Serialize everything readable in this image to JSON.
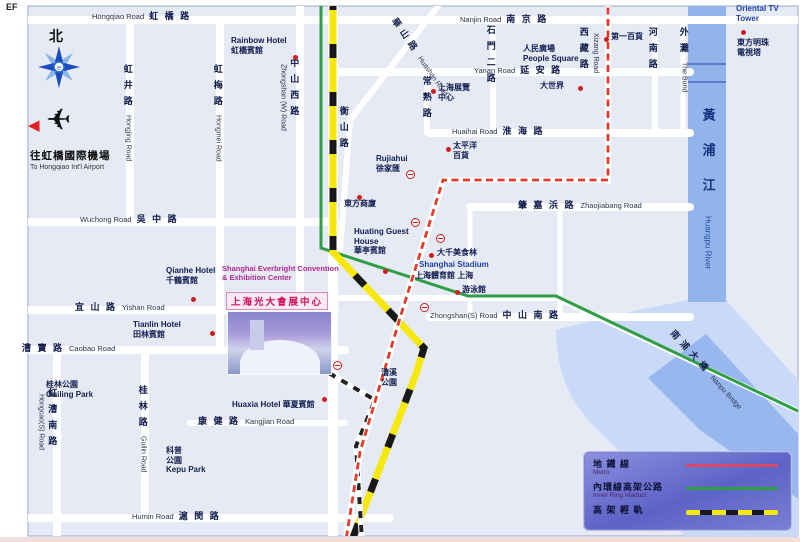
{
  "page": {
    "corner_text": "EF"
  },
  "compass": {
    "north_label": "北"
  },
  "airport": {
    "cn": "往虹橋國際機場",
    "en": "To Hongqiao Int'l Airport"
  },
  "convention": {
    "en_line1": "Shanghai Everbright Convention",
    "en_line2": "& Exhibition Center",
    "banner": "上海光大會展中心"
  },
  "legend": {
    "rows": [
      {
        "cn": "地  鐵  線",
        "en": "Metro",
        "type": "metro"
      },
      {
        "cn": "內環線高架公路",
        "en": "Inner Ring Viaduct",
        "type": "ring"
      },
      {
        "cn": "高 架 輕 軌",
        "en": "",
        "type": "rail"
      }
    ]
  },
  "colors": {
    "metro_red": "#e83828",
    "ring_green": "#2f9e44",
    "rail_yellow": "#f6e80a",
    "river_blue": "#92b4ec",
    "map_bg": "#e6eaf5"
  },
  "map": {
    "labels": [
      {
        "name": "road-hongqiao",
        "k": "rh",
        "en": "Hongqiao Road",
        "cn": "虹 橋 路",
        "x": 92,
        "y": 11
      },
      {
        "name": "road-nanjing",
        "k": "rh",
        "en": "Nanjin Road",
        "cn": "南 京 路",
        "x": 460,
        "y": 14
      },
      {
        "name": "road-yanan",
        "k": "rh",
        "en": "Yanan Road",
        "cn": "延 安 路",
        "x": 474,
        "y": 65
      },
      {
        "name": "road-huaihai",
        "k": "rh",
        "en": "Huaihai Road",
        "cn": "淮 海 路",
        "x": 452,
        "y": 126
      },
      {
        "name": "road-wuzhong",
        "k": "rh",
        "en": "Wuchong Road",
        "cn": "吳 中 路",
        "x": 80,
        "y": 214
      },
      {
        "name": "road-zhaojiabang",
        "k": "rh",
        "cn": "肇 嘉 浜 路",
        "en": "Zhaojiabang Road",
        "cnFirst": true,
        "x": 518,
        "y": 200
      },
      {
        "name": "road-yishan",
        "k": "rh",
        "cn": "宜 山 路",
        "en": "Yishan Road",
        "cnFirst": true,
        "x": 75,
        "y": 302
      },
      {
        "name": "road-zhongshan-s",
        "k": "rh",
        "en": "Zhongshan(S) Road",
        "cn": "中 山 南 路",
        "x": 430,
        "y": 310
      },
      {
        "name": "road-caobao",
        "k": "rh",
        "cn": "漕 寶 路",
        "en": "Caobao Road",
        "cnFirst": true,
        "x": 22,
        "y": 343
      },
      {
        "name": "road-kangjian",
        "k": "rh",
        "cn": "康 健 路",
        "en": "Kangjian Road",
        "cnFirst": true,
        "x": 198,
        "y": 416
      },
      {
        "name": "road-humin",
        "k": "rh",
        "en": "Humin Road",
        "cn": "滬 閔 路",
        "x": 132,
        "y": 511
      },
      {
        "name": "road-hongjing",
        "k": "rv",
        "cn": "虹井路",
        "en": "Hongjing Road",
        "x": 122,
        "y": 64
      },
      {
        "name": "road-hongmei",
        "k": "rv",
        "cn": "虹梅路",
        "en": "Hongmei Road",
        "x": 212,
        "y": 64
      },
      {
        "name": "road-zhongshan-w",
        "k": "rv",
        "cn": "中山西路",
        "en": "Zhongshan (W) Road",
        "side": "l",
        "x": 278,
        "y": 58
      },
      {
        "name": "road-hengshan",
        "k": "rv",
        "cn": "衡山路",
        "x": 338,
        "y": 106
      },
      {
        "name": "road-changshu",
        "k": "rv",
        "cn": "常熟路",
        "x": 421,
        "y": 76
      },
      {
        "name": "road-shimener",
        "k": "rv",
        "cn": "石門二路",
        "x": 485,
        "y": 25
      },
      {
        "name": "road-xizang",
        "k": "rv",
        "cn": "西藏路",
        "en": "Xizang Road",
        "side": "r",
        "x": 578,
        "y": 27
      },
      {
        "name": "road-henan",
        "k": "rv",
        "cn": "河南路",
        "x": 647,
        "y": 27
      },
      {
        "name": "the-bund",
        "k": "rv",
        "cn": "外灘",
        "en": "The Bund",
        "x": 678,
        "y": 27
      },
      {
        "name": "road-guilin",
        "k": "rv",
        "cn": "桂林路",
        "en": "Guilin Road",
        "x": 137,
        "y": 385
      },
      {
        "name": "road-hongcao-s",
        "k": "rv",
        "cn": "虹漕南路",
        "en": "Hongcao(S) Road",
        "side": "l",
        "x": 36,
        "y": 388
      },
      {
        "name": "huangpu-river-label",
        "k": "rv",
        "cls": "riverlbl",
        "cn": "黃浦江",
        "en": "Huangpu River",
        "x": 700,
        "y": 108
      },
      {
        "name": "road-huashan",
        "k": "diag",
        "cn": "華山路",
        "en": "Huashan Road",
        "rot": 55,
        "x": 398,
        "y": 16
      },
      {
        "name": "nanpu-bridge-label",
        "k": "diag",
        "cn": "南浦大橋",
        "en": "Nanpu Bridge",
        "rot": 48,
        "x": 676,
        "y": 328
      },
      {
        "name": "poi-rainbow-hotel",
        "k": "poi",
        "lines": [
          "Rainbow Hotel",
          "虹橋賓館"
        ],
        "x": 231,
        "y": 36
      },
      {
        "name": "poi-qianhe-hotel",
        "k": "poi",
        "lines": [
          "Qianhe Hotel",
          "千鶴賓館"
        ],
        "x": 166,
        "y": 266
      },
      {
        "name": "poi-tianlin-hotel",
        "k": "poi",
        "lines": [
          "Tianlin Hotel",
          "田林賓館"
        ],
        "x": 133,
        "y": 320
      },
      {
        "name": "poi-people-square",
        "k": "poi",
        "lines": [
          "人民廣場",
          "People Square"
        ],
        "x": 523,
        "y": 44
      },
      {
        "name": "poi-shanghai-exhibition-center",
        "k": "poi",
        "lines": [
          "上海展覽",
          "中心"
        ],
        "x": 438,
        "y": 83
      },
      {
        "name": "poi-great-world",
        "k": "poi",
        "lines": [
          "大世界"
        ],
        "x": 540,
        "y": 81
      },
      {
        "name": "poi-no1-department-store",
        "k": "poi",
        "lines": [
          "第一百貨"
        ],
        "x": 611,
        "y": 32
      },
      {
        "name": "poi-oriental-tv-tower-en",
        "k": "poi",
        "cls": "blue",
        "lines": [
          "Oriental TV",
          "Tower"
        ],
        "x": 736,
        "y": 4
      },
      {
        "name": "poi-oriental-tv-tower",
        "k": "poi",
        "lines": [
          "東方明珠",
          "電視塔"
        ],
        "x": 737,
        "y": 38
      },
      {
        "name": "poi-pacific-department-store",
        "k": "poi",
        "lines": [
          "太平洋",
          "百貨"
        ],
        "x": 453,
        "y": 141
      },
      {
        "name": "poi-xujiahui",
        "k": "poi",
        "lines": [
          "Rujiahui",
          "徐家匯"
        ],
        "x": 376,
        "y": 154
      },
      {
        "name": "poi-oriental-shopping-centre",
        "k": "poi",
        "lines": [
          "東方商廈"
        ],
        "x": 344,
        "y": 199
      },
      {
        "name": "poi-huating-guest-house",
        "k": "poi",
        "lines": [
          "Huating Guest",
          "House",
          "華亭賓館"
        ],
        "x": 354,
        "y": 227
      },
      {
        "name": "poi-daqian-gourmet",
        "k": "poi",
        "lines": [
          "大千美食林"
        ],
        "x": 437,
        "y": 248
      },
      {
        "name": "poi-shanghai-stadium-en",
        "k": "poi",
        "cls": "blue",
        "lines": [
          "Shanghai Stadium"
        ],
        "x": 419,
        "y": 260
      },
      {
        "name": "poi-shanghai-stadium",
        "k": "poi",
        "lines": [
          "上海體育館 上海"
        ],
        "x": 415,
        "y": 271
      },
      {
        "name": "poi-swimming-center",
        "k": "poi",
        "lines": [
          "游泳館"
        ],
        "x": 462,
        "y": 285
      },
      {
        "name": "poi-huaxia-hotel",
        "k": "poi",
        "lines": [
          "Huaxia Hotel 華夏賓館"
        ],
        "x": 232,
        "y": 400
      },
      {
        "name": "area-guilin-park",
        "k": "area",
        "lines": [
          "桂林公園",
          "Guiling Park"
        ],
        "x": 46,
        "y": 380
      },
      {
        "name": "area-kepu-park",
        "k": "area",
        "lines": [
          "科普",
          "公園",
          "Kepu Park"
        ],
        "x": 166,
        "y": 446
      },
      {
        "name": "area-caoxi-park",
        "k": "area",
        "lines": [
          "漕溪",
          "公園"
        ],
        "x": 381,
        "y": 368
      }
    ],
    "dots": [
      {
        "x": 293,
        "y": 55
      },
      {
        "x": 191,
        "y": 297
      },
      {
        "x": 210,
        "y": 331
      },
      {
        "x": 431,
        "y": 89
      },
      {
        "x": 578,
        "y": 86
      },
      {
        "x": 604,
        "y": 37
      },
      {
        "x": 741,
        "y": 30
      },
      {
        "x": 446,
        "y": 147
      },
      {
        "x": 357,
        "y": 195
      },
      {
        "x": 383,
        "y": 269
      },
      {
        "x": 429,
        "y": 253
      },
      {
        "x": 455,
        "y": 290
      },
      {
        "x": 322,
        "y": 397
      }
    ],
    "stations": [
      {
        "x": 406,
        "y": 170
      },
      {
        "x": 411,
        "y": 218
      },
      {
        "x": 436,
        "y": 234
      },
      {
        "x": 420,
        "y": 303
      },
      {
        "x": 333,
        "y": 361
      }
    ]
  }
}
